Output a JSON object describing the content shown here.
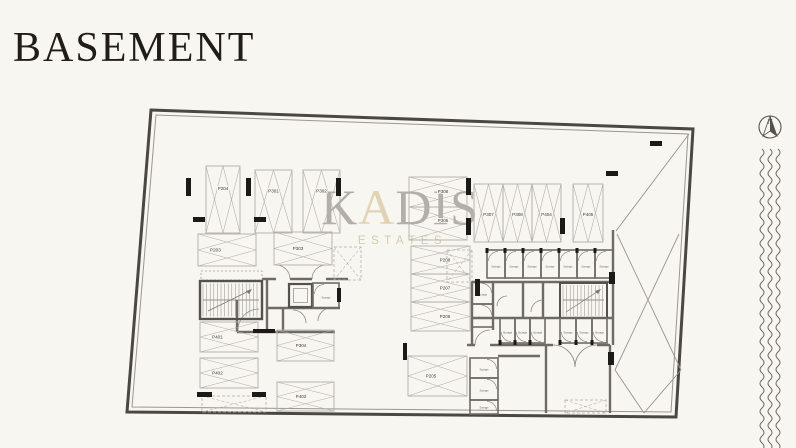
{
  "page": {
    "title": "BASEMENT"
  },
  "watermark": {
    "parts": [
      "K",
      "A",
      "DIS"
    ],
    "subtitle": "ESTATES",
    "gray": "#b2afa9",
    "accent": "#e0d3b4"
  },
  "compass": {
    "label": "N"
  },
  "plan": {
    "colors": {
      "wall": "#6e6b66",
      "wall_dark": "#55524e",
      "spot": "#b2afa8",
      "label": "#45423d",
      "column": "#1c1a17",
      "thin": "#8d8a84",
      "bg": "#f8f6f0"
    },
    "storage_label": "Storage",
    "spots": [
      {
        "label": "P204",
        "x": 206,
        "y": 166,
        "w": 34,
        "h": 67,
        "dir": "v"
      },
      {
        "label": "P301",
        "x": 255,
        "y": 170,
        "w": 37,
        "h": 63,
        "dir": "v"
      },
      {
        "label": "P302",
        "x": 303,
        "y": 170,
        "w": 37,
        "h": 63,
        "dir": "v"
      },
      {
        "label": "P306",
        "x": 409,
        "y": 177,
        "w": 58,
        "h": 30,
        "dir": "h",
        "lx": 443,
        "ly": 193
      },
      {
        "label": "P305",
        "x": 409,
        "y": 207,
        "w": 58,
        "h": 33,
        "dir": "h",
        "lx": 443,
        "ly": 222
      },
      {
        "label": "P307",
        "x": 474,
        "y": 184,
        "w": 29,
        "h": 58,
        "dir": "v",
        "ly": 216
      },
      {
        "label": "P308",
        "x": 503,
        "y": 184,
        "w": 29,
        "h": 58,
        "dir": "v",
        "ly": 216
      },
      {
        "label": "P404",
        "x": 532,
        "y": 184,
        "w": 29,
        "h": 58,
        "dir": "v",
        "ly": 216
      },
      {
        "label": "P405",
        "x": 573,
        "y": 184,
        "w": 30,
        "h": 58,
        "dir": "v",
        "ly": 216
      },
      {
        "label": "P203",
        "x": 198,
        "y": 234,
        "w": 58,
        "h": 32,
        "dir": "h"
      },
      {
        "label": "P303",
        "x": 274,
        "y": 232,
        "w": 58,
        "h": 33,
        "dir": "h",
        "lx": 298
      },
      {
        "label": "P208",
        "x": 411,
        "y": 246,
        "w": 59,
        "h": 28,
        "dir": "h",
        "lx": 445
      },
      {
        "label": "P207",
        "x": 411,
        "y": 274,
        "w": 59,
        "h": 28,
        "dir": "h",
        "lx": 445
      },
      {
        "label": "P206",
        "x": 411,
        "y": 302,
        "w": 59,
        "h": 29,
        "dir": "h",
        "lx": 445
      },
      {
        "label": "P401",
        "x": 200,
        "y": 322,
        "w": 58,
        "h": 30,
        "dir": "h"
      },
      {
        "label": "P402",
        "x": 200,
        "y": 358,
        "w": 58,
        "h": 30,
        "dir": "h"
      },
      {
        "label": "P304",
        "x": 277,
        "y": 330,
        "w": 57,
        "h": 31,
        "dir": "h",
        "lx": 301
      },
      {
        "label": "P403",
        "x": 277,
        "y": 382,
        "w": 57,
        "h": 29,
        "dir": "h",
        "lx": 301
      },
      {
        "label": "P205",
        "x": 408,
        "y": 356,
        "w": 59,
        "h": 40,
        "dir": "h",
        "lx": 431
      }
    ],
    "dashed_spots": [
      {
        "x": 202,
        "y": 396,
        "w": 64,
        "h": 16
      },
      {
        "x": 334,
        "y": 247,
        "w": 27,
        "h": 33
      },
      {
        "x": 447,
        "y": 250,
        "w": 25,
        "h": 32
      },
      {
        "x": 565,
        "y": 400,
        "w": 41,
        "h": 13
      }
    ],
    "storage_rooms": [
      {
        "x": 487,
        "y": 250,
        "w": 18,
        "h": 28,
        "door": "top"
      },
      {
        "x": 505,
        "y": 250,
        "w": 18,
        "h": 28,
        "door": "top"
      },
      {
        "x": 523,
        "y": 250,
        "w": 18,
        "h": 28,
        "door": "top"
      },
      {
        "x": 541,
        "y": 250,
        "w": 18,
        "h": 28,
        "door": "top"
      },
      {
        "x": 559,
        "y": 250,
        "w": 18,
        "h": 28,
        "door": "top"
      },
      {
        "x": 577,
        "y": 250,
        "w": 18,
        "h": 28,
        "door": "top"
      },
      {
        "x": 595,
        "y": 250,
        "w": 18,
        "h": 28,
        "door": "top"
      },
      {
        "x": 472,
        "y": 282,
        "w": 21,
        "h": 22,
        "door": "right"
      },
      {
        "x": 472,
        "y": 304,
        "w": 21,
        "h": 23,
        "door": "right"
      },
      {
        "x": 500,
        "y": 318,
        "w": 15,
        "h": 25,
        "door": "bottom"
      },
      {
        "x": 515,
        "y": 318,
        "w": 15,
        "h": 25,
        "door": "bottom"
      },
      {
        "x": 530,
        "y": 318,
        "w": 15,
        "h": 25,
        "door": "bottom"
      },
      {
        "x": 560,
        "y": 318,
        "w": 16,
        "h": 25,
        "door": "bottom"
      },
      {
        "x": 576,
        "y": 318,
        "w": 16,
        "h": 25,
        "door": "bottom"
      },
      {
        "x": 592,
        "y": 318,
        "w": 15,
        "h": 25,
        "door": "bottom"
      },
      {
        "x": 470,
        "y": 358,
        "w": 28,
        "h": 20,
        "door": "right"
      },
      {
        "x": 470,
        "y": 378,
        "w": 28,
        "h": 22,
        "door": "right"
      },
      {
        "x": 470,
        "y": 400,
        "w": 28,
        "h": 14,
        "door": "right"
      },
      {
        "x": 313,
        "y": 283,
        "w": 26,
        "h": 25,
        "door": "left"
      }
    ],
    "columns": [
      [
        186,
        178,
        5,
        18
      ],
      [
        246,
        178,
        5,
        18
      ],
      [
        336,
        178,
        5,
        18
      ],
      [
        466,
        178,
        5,
        17
      ],
      [
        466,
        218,
        5,
        17
      ],
      [
        560,
        218,
        5,
        16
      ],
      [
        193,
        217,
        12,
        5
      ],
      [
        254,
        217,
        12,
        5
      ],
      [
        606,
        171,
        12,
        5
      ],
      [
        650,
        141,
        12,
        5
      ],
      [
        475,
        279,
        5,
        17
      ],
      [
        403,
        343,
        4,
        17
      ],
      [
        197,
        392,
        15,
        5
      ],
      [
        252,
        392,
        14,
        5
      ],
      [
        337,
        288,
        4,
        14
      ],
      [
        609,
        272,
        6,
        12
      ],
      [
        608,
        352,
        6,
        13
      ],
      [
        253,
        329,
        22,
        4
      ]
    ]
  }
}
